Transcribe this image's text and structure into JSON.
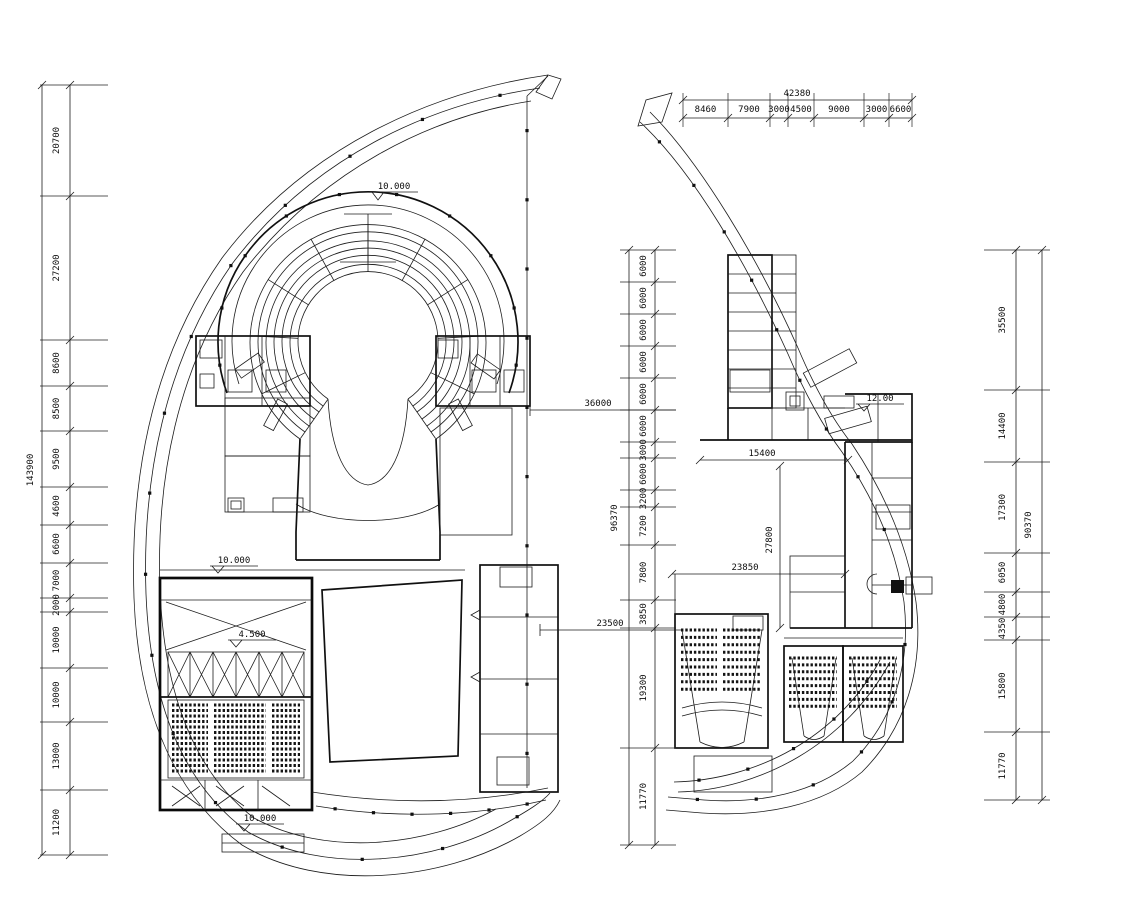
{
  "drawing": {
    "title": "theater-complex-floor-plans",
    "elevations": {
      "amphitheater": "10.000",
      "hall_top": "10.000",
      "stage": "4.500",
      "bottom_stair": "10.000",
      "right_plan": "12.00"
    },
    "leader_dims": {
      "d36000": "36000",
      "d23500": "23500",
      "d15400": "15400",
      "d23850": "23850",
      "d27800": "27800"
    },
    "dims": {
      "left": {
        "total": "143900",
        "values": [
          "20700",
          "27200",
          "8600",
          "8500",
          "9500",
          "4600",
          "6600",
          "7000",
          "2000",
          "10000",
          "10000",
          "13000",
          "11200"
        ]
      },
      "top": {
        "total": "42380",
        "values": [
          "8460",
          "7900",
          "3000",
          "4500",
          "9000",
          "3000",
          "6600"
        ]
      },
      "middle": {
        "total": "96370",
        "values": [
          "6000",
          "6000",
          "6000",
          "6000",
          "6000",
          "6000",
          "3000",
          "6000",
          "3200",
          "7200",
          "7800",
          "3850",
          "19300",
          "11770"
        ]
      },
      "right": {
        "total": "90370",
        "values": [
          "35500",
          "14400",
          "17300",
          "6050",
          "4800",
          "4350",
          "15800",
          "11770"
        ]
      }
    }
  }
}
